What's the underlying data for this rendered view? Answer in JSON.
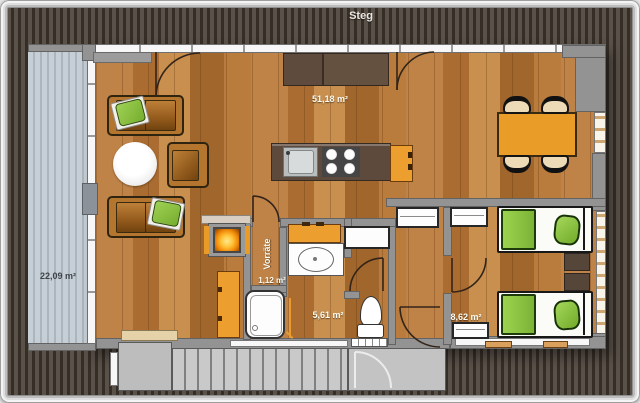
{
  "labels": {
    "steg": "Steg",
    "terrace": "22,09 m²",
    "living": "51,18 m²",
    "pantry_name": "Vorräte",
    "pantry": "1,12 m²",
    "bath": "5,61 m²",
    "bedroom": "8,62 m²"
  },
  "colors": {
    "wood_floor": "#b5773b",
    "deck_dark": "#4a423a",
    "terrace_light": "#b7c1c9",
    "wall_gray": "#939393",
    "accent_orange": "#ec9f2f",
    "accent_green": "#8cc63e",
    "furniture_brown": "#5d4a3c",
    "fire_glow": "#ffb62e"
  }
}
